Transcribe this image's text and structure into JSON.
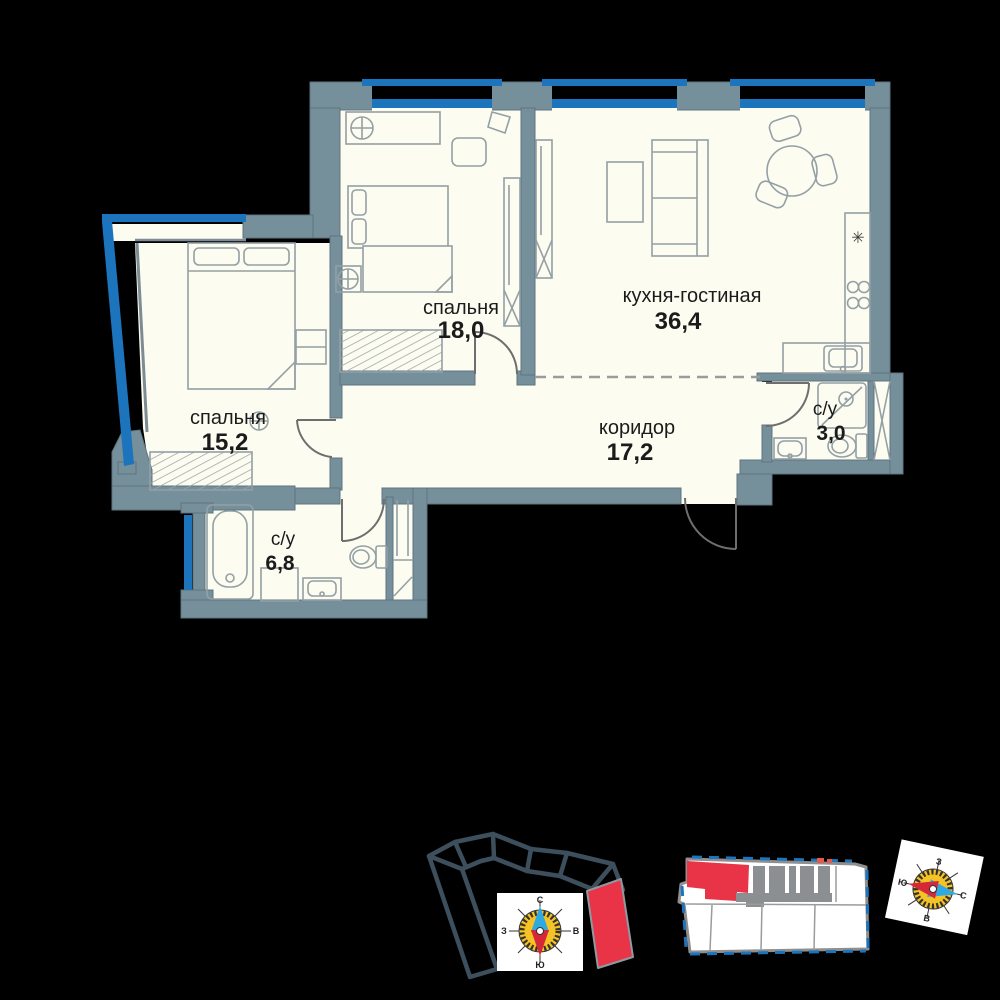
{
  "rooms": {
    "bedroom_18": {
      "label": "спальня",
      "area": "18,0"
    },
    "kitchen_living": {
      "label": "кухня-гостиная",
      "area": "36,4",
      "fridge_symbol": "✳"
    },
    "bedroom_15": {
      "label": "спальня",
      "area": "15,2"
    },
    "corridor": {
      "label": "коридор",
      "area": "17,2"
    },
    "bathroom_small": {
      "label": "с/у",
      "area": "3,0"
    },
    "bathroom_big": {
      "label": "с/у",
      "area": "6,8"
    }
  },
  "compass": {
    "north": "С",
    "east": "В",
    "south": "Ю",
    "west": "З"
  },
  "colors": {
    "background": "#000000",
    "floor": "#FDFCF0",
    "wall": "#76909B",
    "window_blue": "#1C75BC",
    "unit_highlight_red": "#E93448",
    "site_outline": "#3D4F5C",
    "compass_face_yellow": "#F5C324",
    "needle_north_blue": "#2FA9E1",
    "needle_south_red": "#D62839"
  }
}
